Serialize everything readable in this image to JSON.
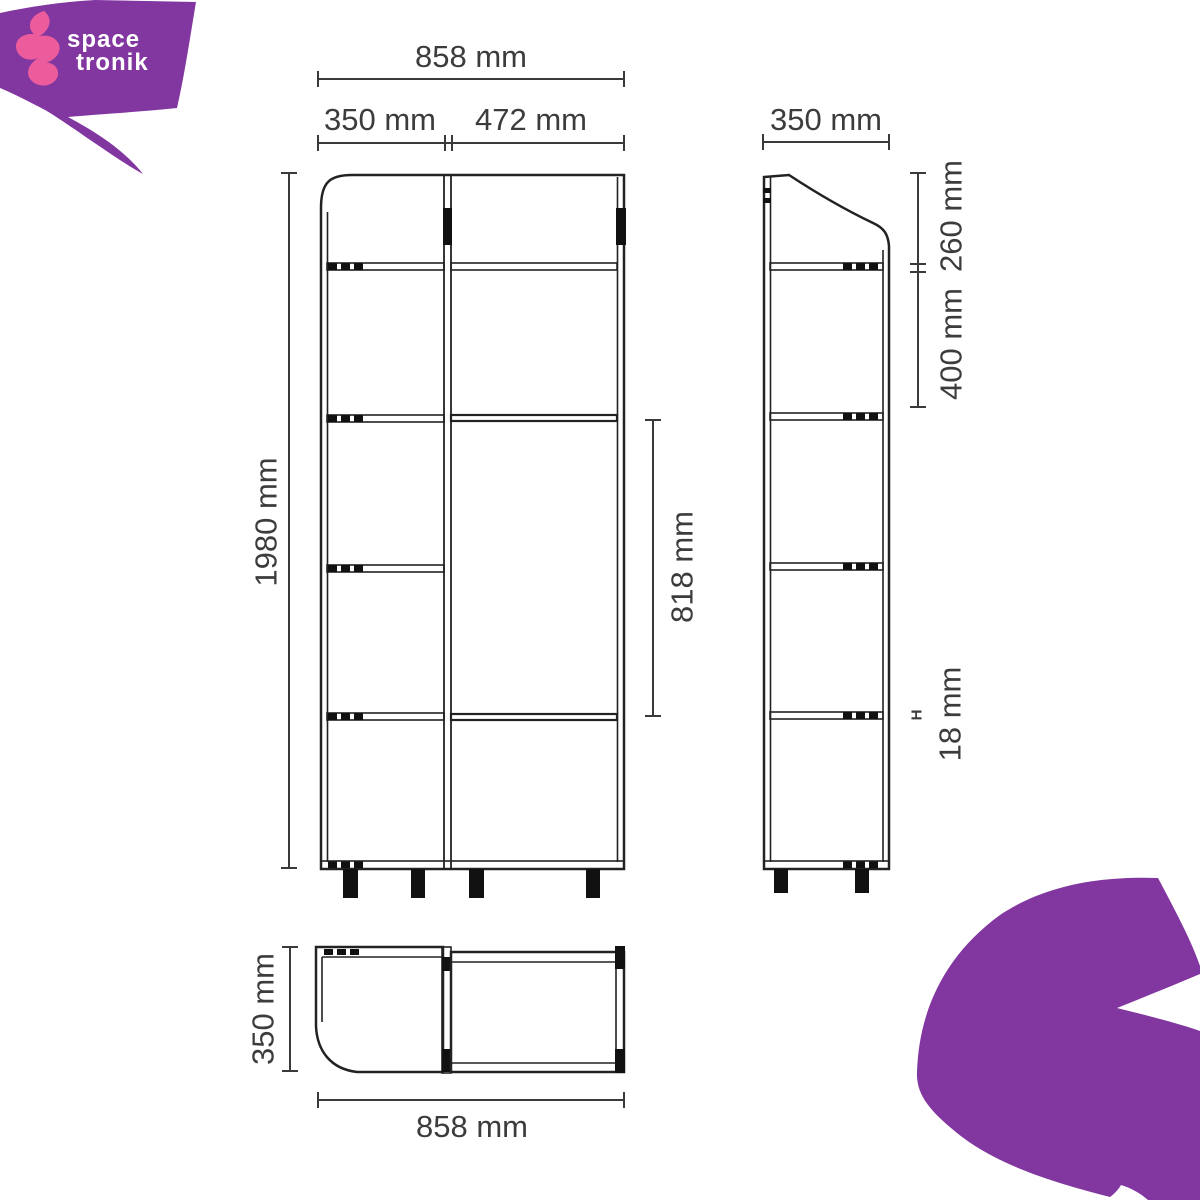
{
  "brand": {
    "name_line1": "space",
    "name_line2": "tronik"
  },
  "colors": {
    "purple": "#8136a0",
    "pink": "#ec5c9c",
    "line": "#222222",
    "dim_line": "#3a3a3a",
    "text": "#3c3c3c"
  },
  "front_view": {
    "total_width": "858 mm",
    "left_width": "350 mm",
    "right_width": "472 mm",
    "total_height": "1980 mm",
    "door_height": "818 mm"
  },
  "side_view": {
    "depth": "350 mm",
    "top_section": "260 mm",
    "middle_section": "400 mm",
    "thickness_symbol": "H",
    "shelf_thickness": "18 mm"
  },
  "top_view": {
    "depth": "350 mm",
    "total_width": "858 mm"
  }
}
